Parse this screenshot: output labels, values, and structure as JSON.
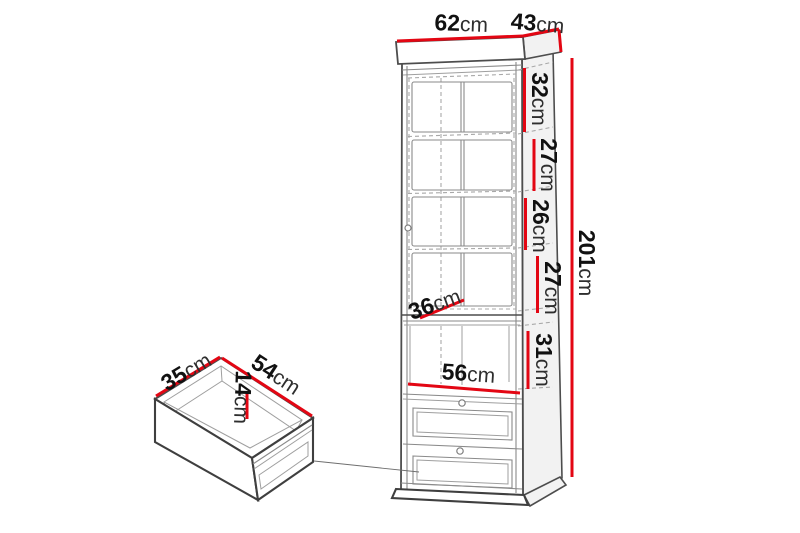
{
  "diagram": {
    "type": "furniture-dimension-diagram",
    "unit": "cm",
    "accent_color": "#e30613",
    "line_color": "#4d4d4d",
    "cabinet": {
      "description": "tall display cabinet with glass door, open shelf niche and two drawers",
      "top_width": {
        "value": "62",
        "unit": "cm"
      },
      "top_depth": {
        "value": "43",
        "unit": "cm"
      },
      "total_height": {
        "value": "201",
        "unit": "cm"
      },
      "sections": [
        {
          "value": "32",
          "unit": "cm"
        },
        {
          "value": "27",
          "unit": "cm"
        },
        {
          "value": "26",
          "unit": "cm"
        },
        {
          "value": "27",
          "unit": "cm"
        },
        {
          "value": "31",
          "unit": "cm"
        }
      ],
      "shelf_depth": {
        "value": "36",
        "unit": "cm"
      },
      "interior_width": {
        "value": "56",
        "unit": "cm"
      }
    },
    "drawer": {
      "description": "inner drawer box shown separately",
      "depth": {
        "value": "35",
        "unit": "cm"
      },
      "width": {
        "value": "54",
        "unit": "cm"
      },
      "height": {
        "value": "14",
        "unit": "cm"
      }
    }
  }
}
